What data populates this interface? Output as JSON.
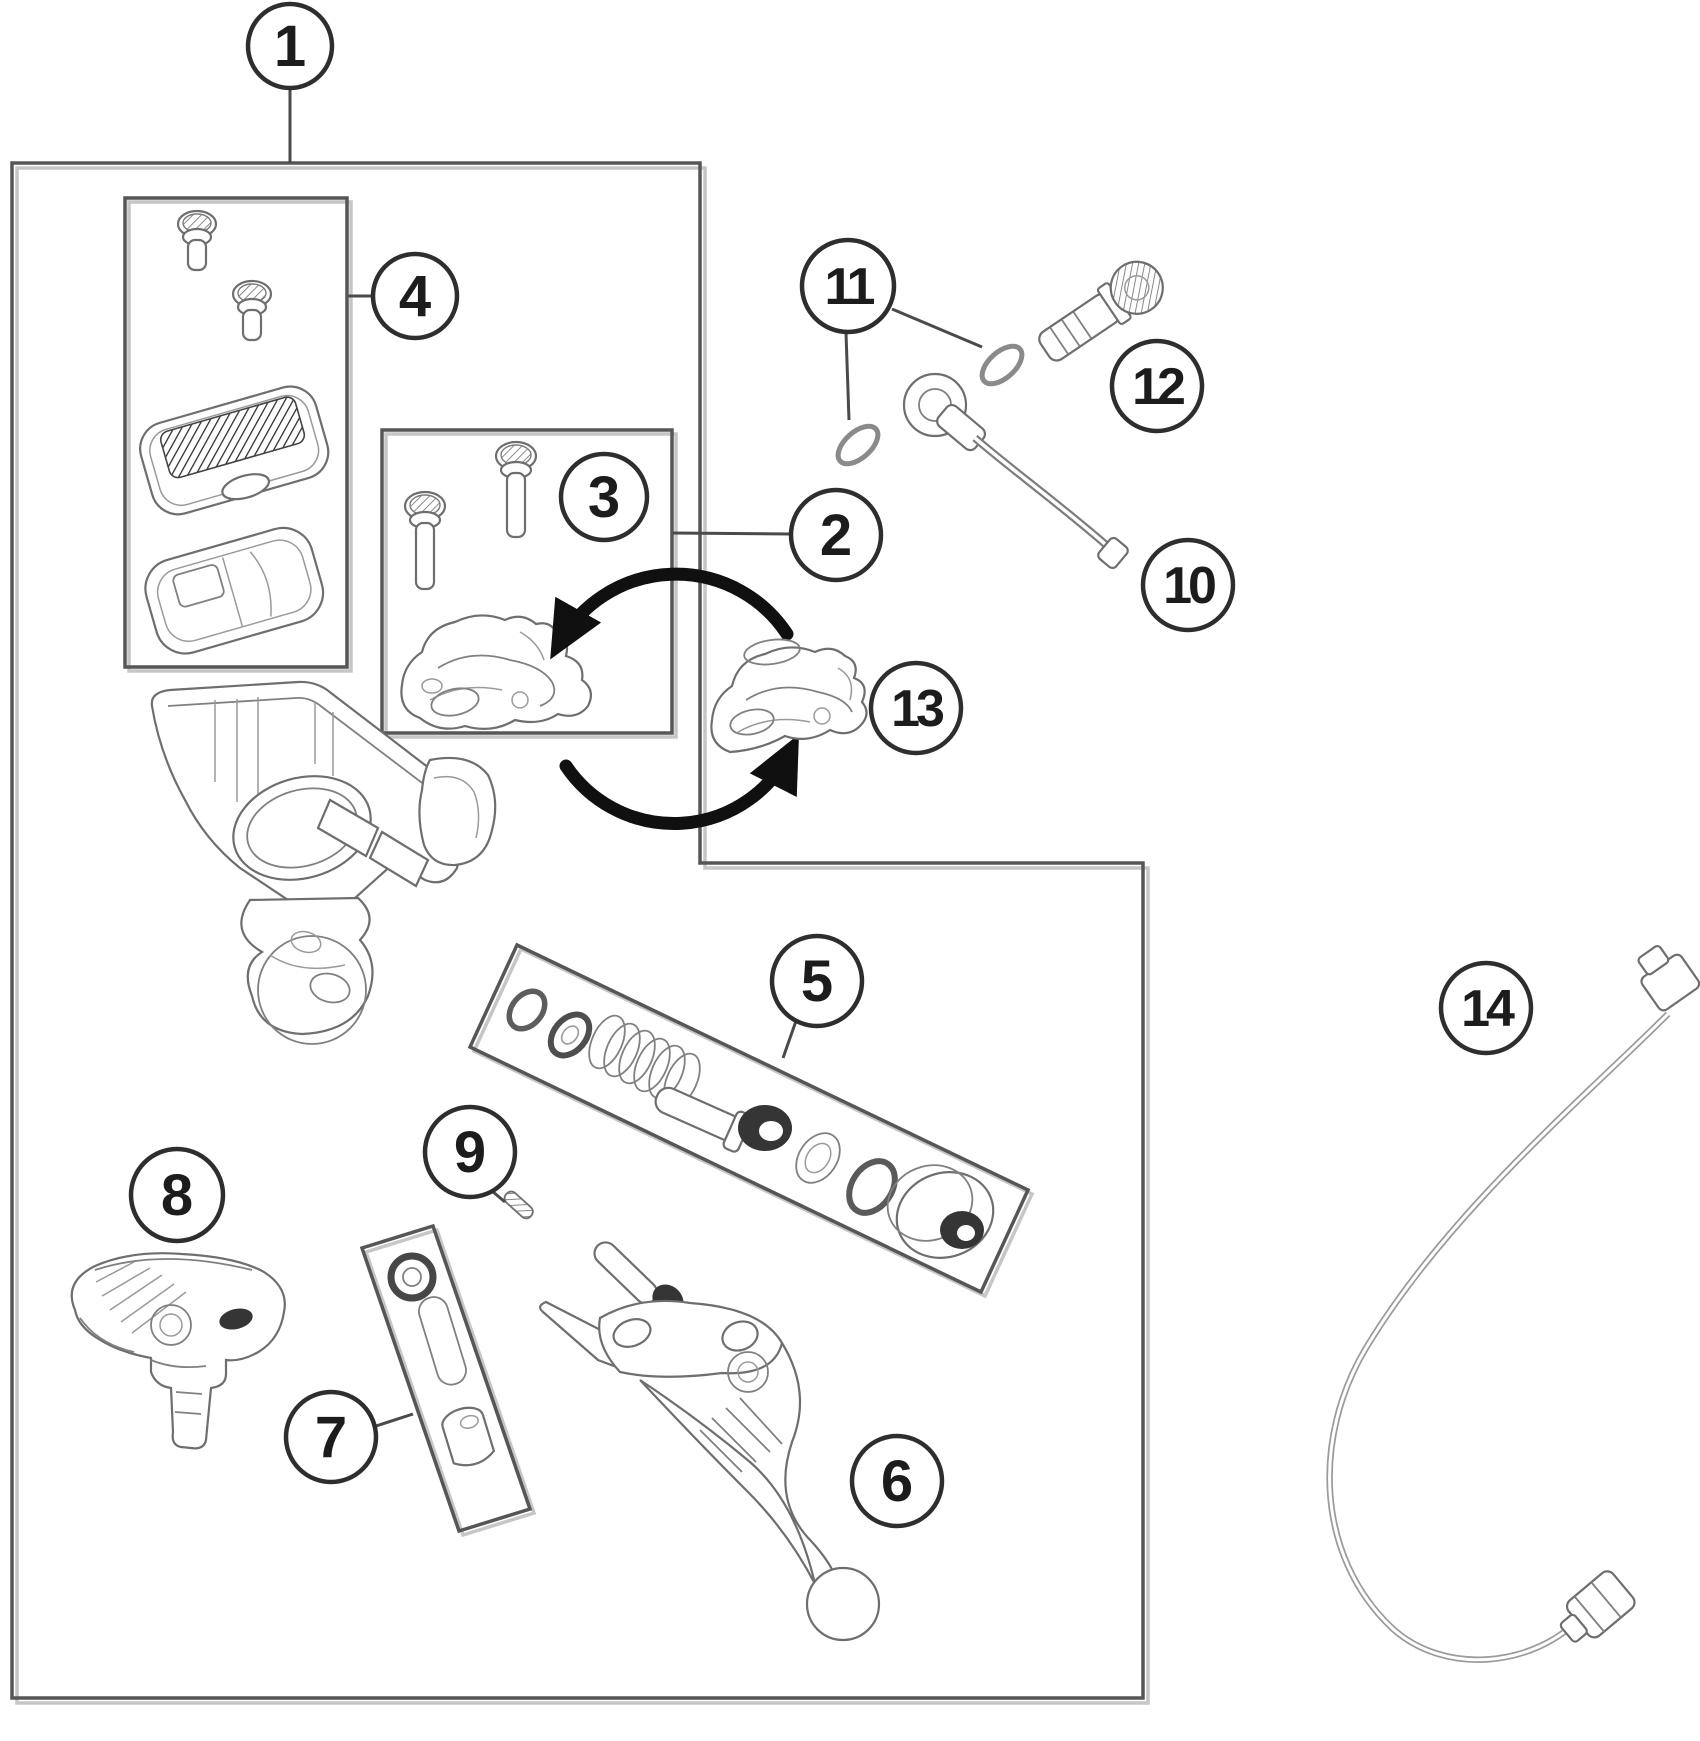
{
  "figure": {
    "type": "exploded-parts-diagram",
    "background": "#ffffff",
    "line_color": "#6e6e6e",
    "border_color": "#565656",
    "callout_color": "#2e2e2e",
    "arrow_color": "#101010"
  },
  "callouts": {
    "c1": "1",
    "c2": "2",
    "c3": "3",
    "c4": "4",
    "c5": "5",
    "c6": "6",
    "c7": "7",
    "c8": "8",
    "c9": "9",
    "c10": "10",
    "c11": "11",
    "c12": "12",
    "c13": "13",
    "c14": "14"
  }
}
